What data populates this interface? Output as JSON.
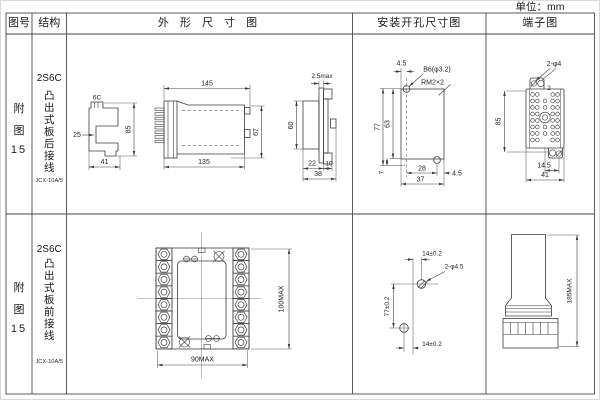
{
  "unit_label": "单位：mm",
  "header": {
    "fig_no": "图号",
    "structure": "结构",
    "outline": "外 形 尺 寸 图",
    "install": "安装开孔尺寸图",
    "terminal": "端子图"
  },
  "row1": {
    "fig": {
      "c1": "附",
      "c2": "图",
      "c3": "15"
    },
    "model": "2S6C",
    "desc": "凸出式板后接线",
    "sub_model": "JCX-10A/5",
    "outline": {
      "side_label": "6C",
      "side_left": "25",
      "side_height": "85",
      "side_width": "41",
      "top_width": "145",
      "body_width": "135",
      "body_height": "67",
      "panel_thick": "2.5max",
      "panel_height": "60",
      "d22": "22",
      "d10": "10",
      "d38": "38"
    },
    "install": {
      "offset_top": "4.5",
      "hole_spec": "B6(φ3.2)",
      "thread_spec": "RM2×2",
      "h77": "77",
      "h63": "63",
      "h7": "7",
      "w28": "28",
      "w37": "37",
      "offset_right": "4.5"
    },
    "terminal": {
      "hole_spec": "2-φ4",
      "count_label": "2",
      "height": "85",
      "w145": "14.5",
      "w41": "41"
    }
  },
  "row2": {
    "fig": {
      "c1": "附",
      "c2": "图",
      "c3": "15"
    },
    "model": "2S6C",
    "desc": "凸出式板前接线",
    "sub_model": "JCX-10A/5",
    "outline": {
      "height": "100MAX",
      "width": "90MAX"
    },
    "install": {
      "top": "14±0.2",
      "hole_spec": "2-φ4.5",
      "height": "77±0.2",
      "bottom": "14±0.2"
    },
    "terminal": {
      "height": "185MAX"
    }
  }
}
